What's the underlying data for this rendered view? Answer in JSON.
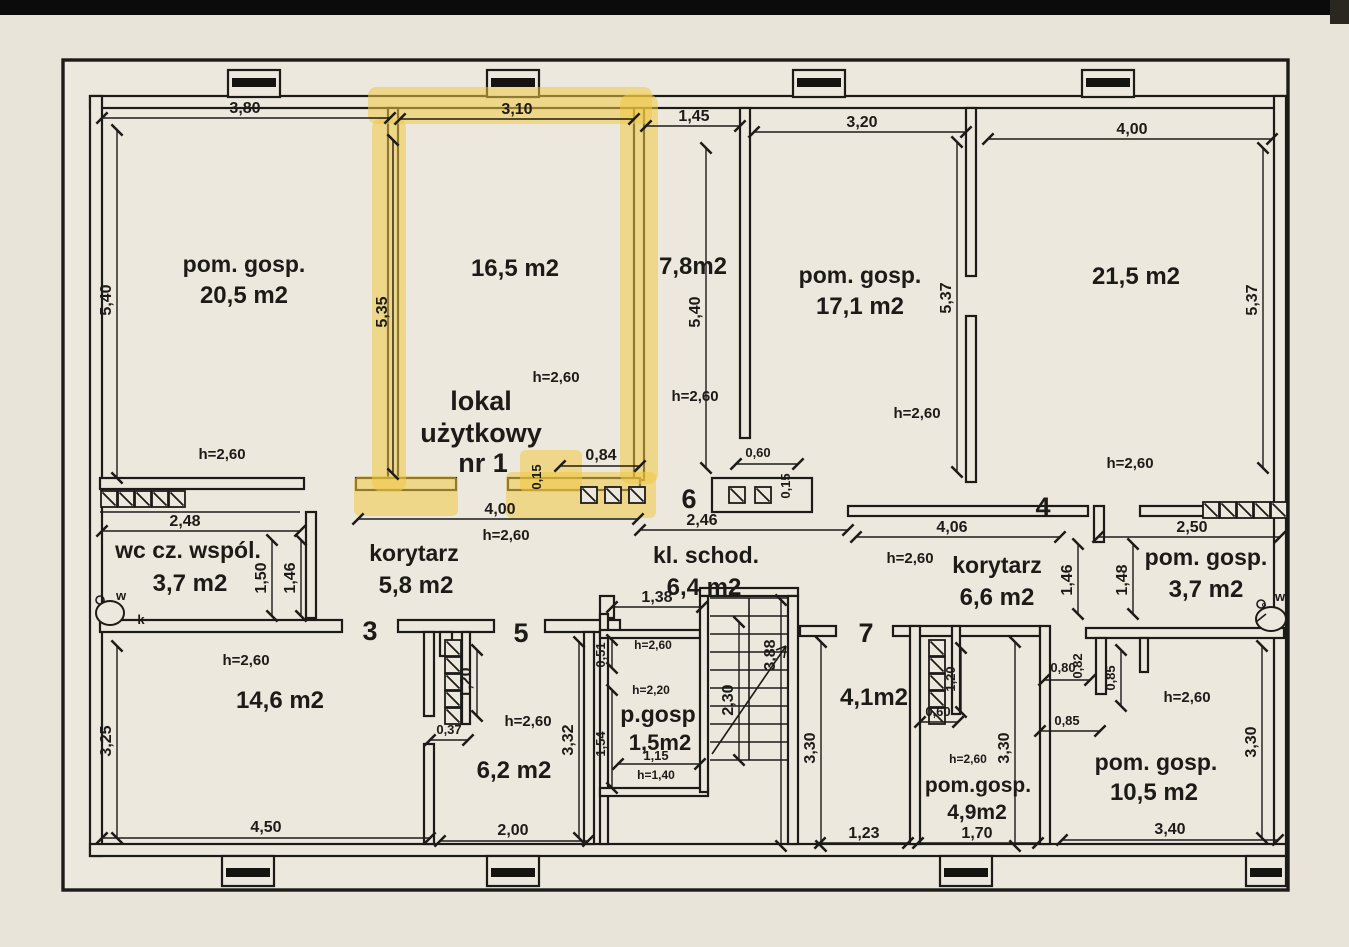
{
  "palette": {
    "paper": "#e9e4d9",
    "paper_light": "#ece8de",
    "ink": "#1d1b18",
    "highlight": "#f0c844",
    "photo_edge": "#0b0b0b"
  },
  "rooms": [
    {
      "name": "pom. gosp.",
      "area": "20,5 m2",
      "height": "h=2,60"
    },
    {
      "area": "16,5 m2",
      "height": "h=2,60",
      "title_line1": "lokal",
      "title_line2": "użytkowy",
      "title_line3": "nr 1"
    },
    {
      "area": "7,8m2",
      "height": "h=2,60"
    },
    {
      "name": "pom. gosp.",
      "area": "17,1 m2",
      "height": "h=2,60"
    },
    {
      "area": "21,5 m2",
      "height": "h=2,60"
    },
    {
      "name": "wc cz. wspól.",
      "area": "3,7 m2"
    },
    {
      "name": "korytarz",
      "area": "5,8 m2",
      "height": "h=2,60"
    },
    {
      "name": "kl. schod.",
      "area": "6,4 m2"
    },
    {
      "name": "korytarz",
      "area": "6,6 m2",
      "height": "h=2,60"
    },
    {
      "name": "pom. gosp.",
      "area": "3,7 m2"
    },
    {
      "area": "14,6 m2",
      "height": "h=2,60"
    },
    {
      "area": "6,2 m2",
      "height": "h=2,60"
    },
    {
      "name": "p.gosp",
      "area": "1,5m2",
      "height_top": "h=2,60",
      "height_mid": "h=2,20",
      "height_low": "h=1,40"
    },
    {
      "area": "4,1m2"
    },
    {
      "name": "pom.gosp.",
      "area": "4,9m2",
      "height": "h=2,60"
    },
    {
      "name": "pom. gosp.",
      "area": "10,5 m2",
      "height": "h=2,60"
    }
  ],
  "unit_numbers": {
    "u3": "3",
    "u4": "4",
    "u5": "5",
    "u6": "6",
    "u7": "7"
  },
  "fixtures": {
    "wc_w": "w",
    "wc_k": "k",
    "right_deg": "°",
    "right_w": "w"
  },
  "dims": {
    "r205_top": "3,80",
    "r205_left": "5,40",
    "lokal_top": "3,10",
    "lokal_left": "5,35",
    "c78_top": "1,45",
    "c78_side": "5,40",
    "r171_top": "3,20",
    "r171_side": "5,37",
    "r171_door": "0,60",
    "r171_wall": "0,15",
    "r215_top": "4,00",
    "r215_side": "5,37",
    "wc_top": "2,48",
    "wc_v1": "1,50",
    "wc_v2": "1,46",
    "kor58_top": "4,00",
    "lokal_door": "0,84",
    "lokal_wall": "0,15",
    "klschod_top": "2,46",
    "kor66_top": "4,06",
    "kor66_v1": "1,46",
    "kor66_v2": "1,48",
    "pg37_top": "2,50",
    "r146_left": "3,25",
    "r146_bottom": "4,50",
    "r62_niche": "1,20",
    "r62_door": "0,37",
    "r62_side": "3,32",
    "r62_bottom": "2,00",
    "pg15_top": "1,38",
    "pg15_v1": "0,51",
    "pg15_v2": "1,54",
    "pg15_inner": "1,15",
    "stair_depth": "2,30",
    "stair_total": "3,88",
    "r41_side": "3,30",
    "r41_bottom": "1,23",
    "r49_niche_w": "0,60",
    "r49_niche_h": "1,20",
    "r49_side": "3,30",
    "r49_bottom": "1,70",
    "r105_n1": "0,80",
    "r105_n2": "0,82",
    "r105_n3": "0,85",
    "r105_n4": "0,85",
    "r105_side": "3,30",
    "r105_bottom": "3,40"
  }
}
